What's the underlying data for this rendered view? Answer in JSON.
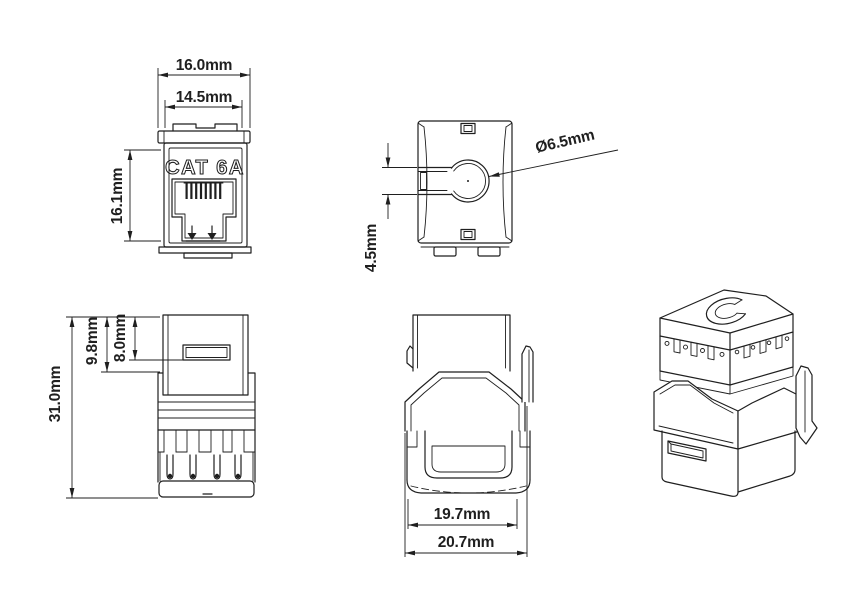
{
  "page": {
    "background": "#ffffff",
    "line_color": "#1f1f1f"
  },
  "views": {
    "front": {
      "product_label": "CAT 6A",
      "dims": {
        "outer_width": "16.0mm",
        "inner_width": "14.5mm",
        "height": "16.1mm"
      }
    },
    "top": {
      "dims": {
        "hole_diameter": "Ø6.5mm",
        "hole_offset": "4.5mm"
      }
    },
    "side": {
      "dims": {
        "total_height": "31.0mm",
        "upper_depth": "9.8mm",
        "slot_depth": "8.0mm"
      }
    },
    "rear": {
      "dims": {
        "body_width": "19.7mm",
        "overall_width": "20.7mm"
      }
    }
  }
}
